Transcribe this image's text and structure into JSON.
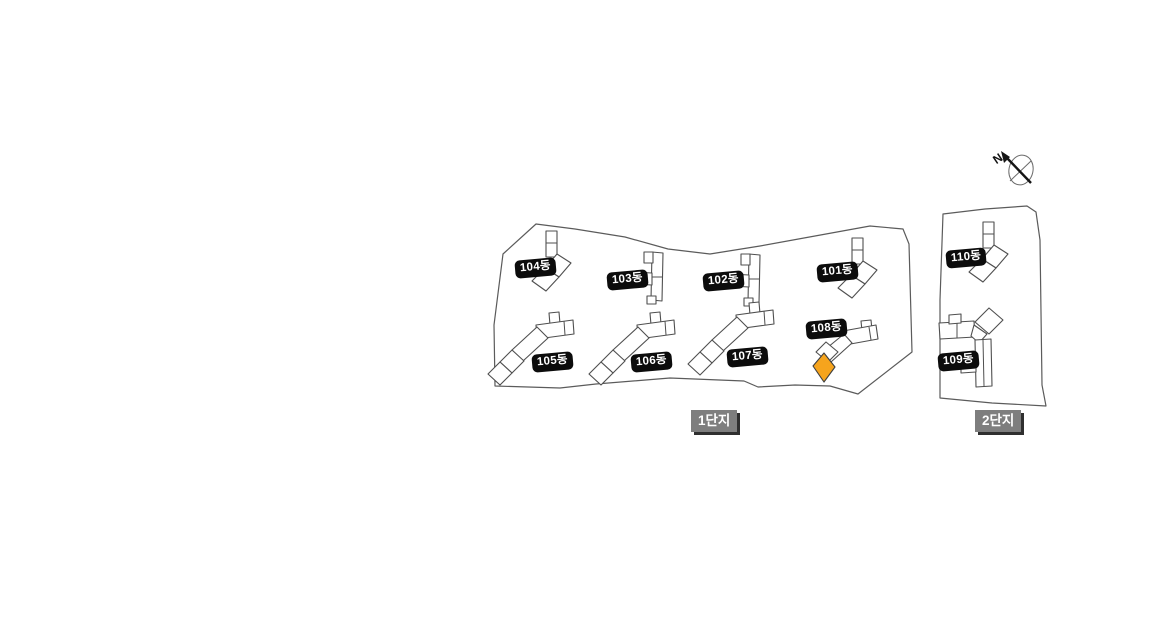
{
  "compass": {
    "label": "N"
  },
  "selected_unit": {
    "color": "#F6A41D",
    "building": "108동"
  },
  "complexes": [
    {
      "label": "1단지",
      "buildings": [
        {
          "label": "101동"
        },
        {
          "label": "102동"
        },
        {
          "label": "103동"
        },
        {
          "label": "104동"
        },
        {
          "label": "105동"
        },
        {
          "label": "106동"
        },
        {
          "label": "107동"
        },
        {
          "label": "108동"
        }
      ]
    },
    {
      "label": "2단지",
      "buildings": [
        {
          "label": "109동"
        },
        {
          "label": "110동"
        }
      ]
    }
  ]
}
